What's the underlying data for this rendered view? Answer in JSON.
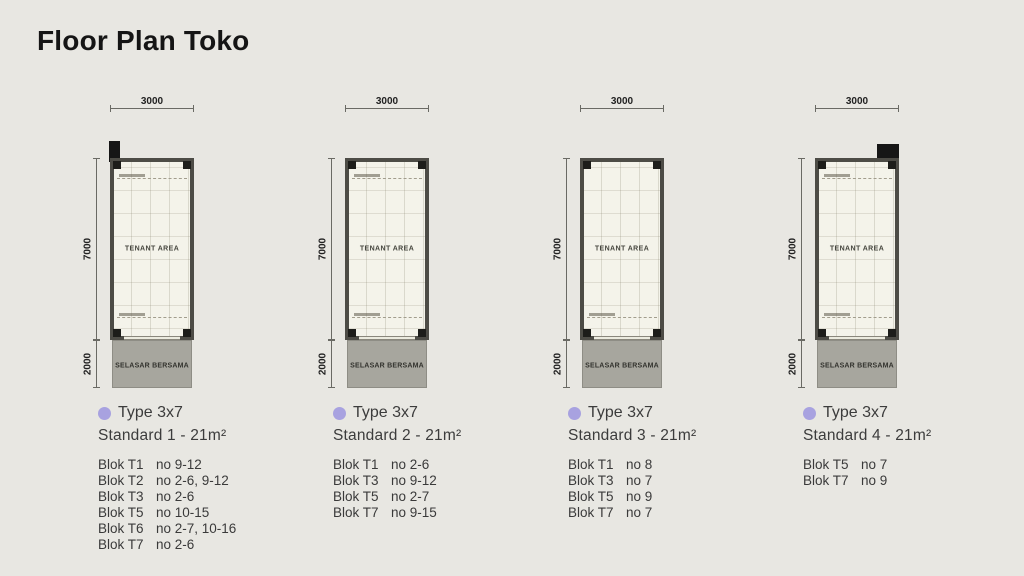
{
  "page": {
    "title": "Floor Plan Toko"
  },
  "colors": {
    "background": "#e8e7e2",
    "bullet": "#a8a2e0",
    "wall": "#4d4c46",
    "selasar_fill": "#a7a69e",
    "tenant_fill": "#f4f3ea"
  },
  "plan": {
    "dim_width": "3000",
    "dim_height": "7000",
    "dim_selasar": "2000",
    "tenant_label": "TENANT AREA",
    "selasar_label": "SELASAR BERSAMA"
  },
  "panels": [
    {
      "type_label": "Type 3x7",
      "standard_label": "Standard 1 - 21m²",
      "corner_marker": "top-left",
      "note_top": true,
      "bloks": [
        {
          "blok": "Blok T1",
          "no": "no 9-12"
        },
        {
          "blok": "Blok T2",
          "no": "no 2-6, 9-12"
        },
        {
          "blok": "Blok T3",
          "no": "no 2-6"
        },
        {
          "blok": "Blok T5",
          "no": "no 10-15"
        },
        {
          "blok": "Blok T6",
          "no": "no 2-7, 10-16"
        },
        {
          "blok": "Blok T7",
          "no": "no 2-6"
        }
      ]
    },
    {
      "type_label": "Type 3x7",
      "standard_label": "Standard 2 - 21m²",
      "corner_marker": "none",
      "note_top": true,
      "bloks": [
        {
          "blok": "Blok T1",
          "no": "no 2-6"
        },
        {
          "blok": "Blok T3",
          "no": "no 9-12"
        },
        {
          "blok": "Blok T5",
          "no": "no 2-7"
        },
        {
          "blok": "Blok T7",
          "no": "no 9-15"
        }
      ]
    },
    {
      "type_label": "Type 3x7",
      "standard_label": "Standard 3 - 21m²",
      "corner_marker": "none",
      "note_top": false,
      "bloks": [
        {
          "blok": "Blok T1",
          "no": "no 8"
        },
        {
          "blok": "Blok T3",
          "no": "no 7"
        },
        {
          "blok": "Blok T5",
          "no": "no 9"
        },
        {
          "blok": "Blok T7",
          "no": "no 7"
        }
      ]
    },
    {
      "type_label": "Type 3x7",
      "standard_label": "Standard 4 - 21m²",
      "corner_marker": "top-right",
      "note_top": true,
      "bloks": [
        {
          "blok": "Blok T5",
          "no": "no 7"
        },
        {
          "blok": "Blok T7",
          "no": "no 9"
        }
      ]
    }
  ]
}
